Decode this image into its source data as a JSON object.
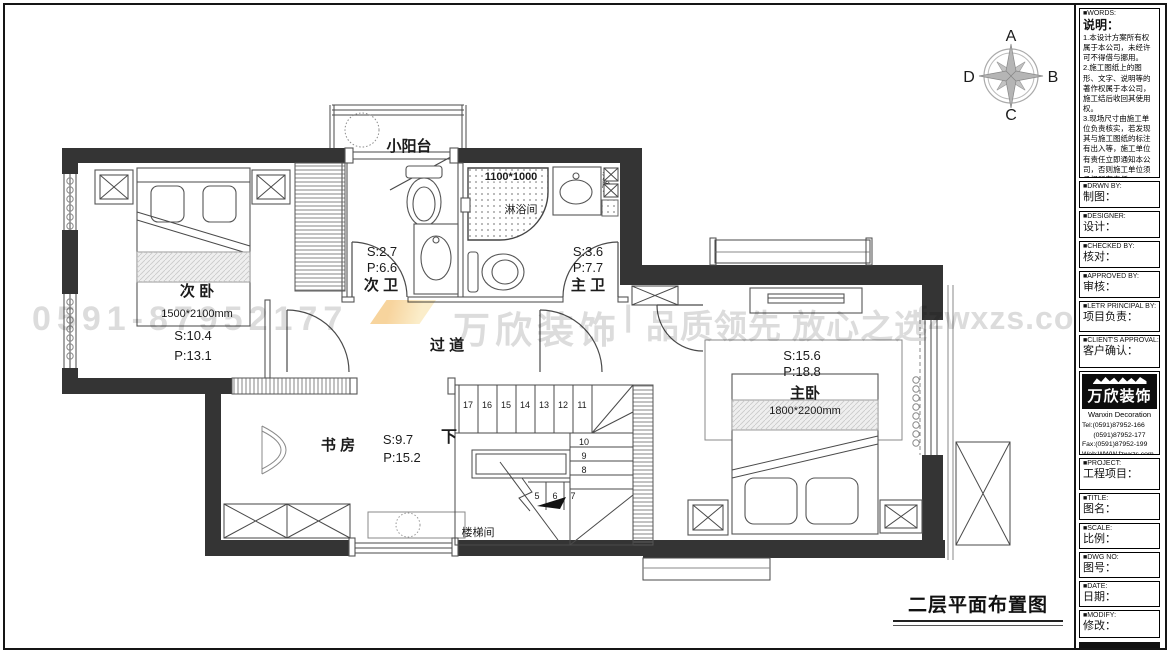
{
  "compass": {
    "n": "A",
    "e": "B",
    "s": "C",
    "w": "D"
  },
  "watermark": {
    "phone": "0591-87952177",
    "brand": "万欣装饰",
    "divider": "|",
    "slogan": "品质领先 放心之选",
    "website": "fzwxzs.com"
  },
  "plan": {
    "caption": "二层平面布置图",
    "balcony": {
      "name": "小阳台"
    },
    "secondary_bedroom": {
      "name": "次 卧",
      "bed_size": "1500*2100mm",
      "area": "S:10.4",
      "perimeter": "P:13.1"
    },
    "secondary_bath": {
      "name": "次 卫",
      "area": "S:2.7",
      "perimeter": "P:6.6"
    },
    "shower": {
      "name": "淋浴间",
      "size": "1100*1000"
    },
    "basin": {
      "label": "洗脸台"
    },
    "master_bath": {
      "name": "主 卫",
      "area": "S:3.6",
      "perimeter": "P:7.7"
    },
    "corridor": {
      "name": "过 道"
    },
    "master_bedroom": {
      "name": "主卧",
      "bed_size": "1800*2200mm",
      "area": "S:15.6",
      "perimeter": "P:18.8"
    },
    "study": {
      "name": "书 房",
      "area": "S:9.7",
      "perimeter": "P:15.2"
    },
    "stairwell": {
      "name": "楼梯间",
      "down": "下",
      "steps_top": [
        "17",
        "16",
        "15",
        "14",
        "13",
        "12",
        "11"
      ],
      "steps_right": [
        "10",
        "9",
        "8"
      ],
      "steps_bottom": [
        "5",
        "6",
        "7"
      ]
    }
  },
  "titleblock": {
    "notes": {
      "tag": "■WORDS:",
      "title": "说明：",
      "body": "1.本设计方案所有权属于本公司，未经许可不得借与挪用。\n2.施工图纸上的图形、文字、说明等的著作权属于本公司，施工结后收回其使用权。\n3.现场尺寸由施工单位负责核实，若发现其与施工图纸的标注有出入等，施工单位有责任立即通知本公司，否则施工单位须承担所有责任。\n4.本设计方案是按客户要求设计，经客户签字确认为同意认可，不得随意更改。"
    },
    "fields": [
      {
        "tag": "■DRWN BY:",
        "label": "制图："
      },
      {
        "tag": "■DESIGNER:",
        "label": "设计："
      },
      {
        "tag": "■CHECKED BY:",
        "label": "核对："
      },
      {
        "tag": "■APPROVED BY:",
        "label": "审核："
      },
      {
        "tag": "■LETR PRINCIPAL BY:",
        "label": "项目负责："
      },
      {
        "tag": "■CLIENT'S APPROVAL:",
        "label": "客户确认："
      }
    ],
    "brand": {
      "logo_text": "万欣装饰",
      "logo_sub": "Wanxin Decoration",
      "contacts": "Tel:(0591)87952-166\n      (0591)87952-177\nFax:(0591)87952-199\nWeb:WWW.fzwxzs.com"
    },
    "fields2": [
      {
        "tag": "■PROJECT:",
        "label": "工程项目："
      },
      {
        "tag": "■TITLE:",
        "label": "图名："
      },
      {
        "tag": "■SCALE:",
        "label": "比例："
      },
      {
        "tag": "■DWG NO:",
        "label": "图号："
      },
      {
        "tag": "■DATE:",
        "label": "日期："
      },
      {
        "tag": "■MODIFY:",
        "label": "修改："
      }
    ]
  }
}
